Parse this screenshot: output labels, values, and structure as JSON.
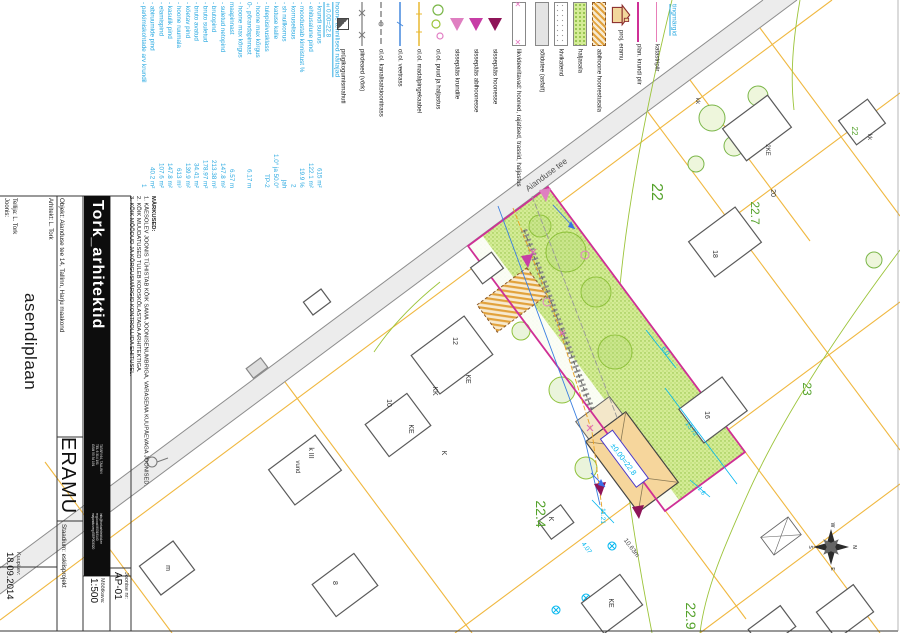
{
  "titleblock": {
    "joonis_label": "Joonis:",
    "tellija": "Tellija: L. Tork",
    "arhitekt": "Arhitekt: L. Tork",
    "drawing_title": "asendiplaan",
    "objekt": "Objekt: Aianduse tee 14, Tallinn, Harju maakond",
    "project_name": "ERAMU",
    "staadium": "Staadium: eskiisprojekt",
    "kuupaev_label": "Kuupäev:",
    "kuupaev": "18.09.2014",
    "mootkava_label": "Mõõtkava:",
    "mootkava": "1:500",
    "joonise_nr_label": "Joonise nr:",
    "joonise_nr": "AP-01",
    "logo": "Tork_arhitektid",
    "address": [
      "TATARI 64, TALLINN",
      "TEL 6 314 191",
      "GSM 50 34 191"
    ],
    "registry": [
      "info@torkarhitektid.ee",
      "reg.kood 80319140",
      "majandusreg EEP003320"
    ]
  },
  "notes": {
    "header": "MÄRKUSED:",
    "items": [
      "1. KÄESOLEV JOONIS TÜHISTAB KÕIK SAMA JOONISENUMBRIGA, VARASEMA KUUPÄEVAGA JOONISED.",
      "2. KÕIK MUUDATUSED TULEB KOOSKÕLASTADA ARHITEKTIGA.",
      "3. KÕIK MÕÕDUD JA KÕRGUSMÄRGID KONTROLLIDA EHITUSEL."
    ]
  },
  "tech": {
    "header": "hoone tehnilised näitajad",
    "benchmark": "±0.00=22.8",
    "rows": [
      {
        "label": "krundi suurus",
        "value": "615 m²"
      },
      {
        "label": "ehitusalune pind",
        "value": "122.1 m²"
      },
      {
        "label": "moodustab kinnistust %",
        "value": "19.9 %"
      },
      {
        "label": "korruselisus",
        "value": "2"
      },
      {
        "label": "sh nullkorrus",
        "value": "jah"
      },
      {
        "label": "katuse kalle",
        "value": "1.0° ja 50.0°"
      },
      {
        "label": "tulepüsivusklass",
        "value": "TP-2"
      },
      {
        "label": "hoone max kõrgus",
        "value": ""
      },
      {
        "label": "0-, põrandapinnast",
        "value": "6.17 m"
      },
      {
        "label": "hoone max kõrgus",
        "value": ""
      },
      {
        "label": "maapinnast",
        "value": "6.57 m"
      },
      {
        "label": "suletud netopind",
        "value": "147.8 m²"
      },
      {
        "label": "brutopind",
        "value": "213.38 m²"
      },
      {
        "label": "bruto suletud",
        "value": "178.97 m²"
      },
      {
        "label": "bruto avatud",
        "value": "34.41 m²"
      },
      {
        "label": "köetav pind",
        "value": "139.9 m²"
      },
      {
        "label": "hoone ruumala",
        "value": "613 m³"
      },
      {
        "label": "kasulik pind",
        "value": "147.8 m²"
      },
      {
        "label": "elamispind",
        "value": "107.6 m²"
      },
      {
        "label": "abiruumide pind",
        "value": "40.2 m²"
      },
      {
        "label": "parkimiskohtade arv krundil",
        "value": "1"
      }
    ]
  },
  "legend": {
    "items": [
      {
        "label": "abihoone hoonestusala"
      },
      {
        "label": "haljasala"
      },
      {
        "label": "kivikatend"
      },
      {
        "label": "sõidutee (asfalt)"
      },
      {
        "label": "likvideeritavad: hooned, rajatised, trassid, haljastus"
      },
      {
        "label": "sissepääs hoonesse"
      },
      {
        "label": "sissepääs abihoonesse"
      },
      {
        "label": "sissepääs krundile"
      },
      {
        "label": "ol.ol. puud ja haljastus"
      },
      {
        "label": "ol.ol. madalpingekaabel"
      },
      {
        "label": "ol.ol. veetrass"
      },
      {
        "label": "ol.ol. kanalisatsioonitrass"
      },
      {
        "label": "piirdeaed (võrk)"
      },
      {
        "label": "prügikogumismahuti"
      }
    ]
  },
  "corner_legend": {
    "header": "tingmärgid",
    "items": [
      {
        "label": "katastripiir"
      },
      {
        "label": "plan. krundi piir"
      },
      {
        "label": "proj. eramu"
      }
    ]
  },
  "map": {
    "road_name": "Aianduse tee",
    "benchmark": "±0.00=22.8",
    "plots": {
      "p22": "22",
      "p227": "22.7",
      "p23": "23",
      "p224": "22.4",
      "p229": "22.9",
      "p22s": "22"
    },
    "dims": {
      "d1": "13.72",
      "d2": "1.6",
      "d3": "11.21",
      "d4": "4.07",
      "d5": "6.0",
      "side": "10.63m"
    },
    "houses": {
      "h20": "20",
      "h18": "18",
      "h16": "16",
      "h12": "12",
      "h10": "10",
      "h8": "8",
      "hm": "m",
      "ke1": "KE",
      "kk1": "KK",
      "ke2": "KE",
      "k1": "K",
      "kIII": "k III",
      "vund": "vund",
      "keb": "KE",
      "ks": "K",
      "kk2": "kk",
      "kk3": "kk",
      "h2ke": "2KE"
    },
    "compass": {
      "n": "N",
      "e": "E",
      "s": "S",
      "w": "W"
    }
  },
  "colors": {
    "cyan_text": "#2aa9e1",
    "dim_cyan": "#00b6ef",
    "plot_green": "#54a22b",
    "boundary_yellow": "#f0b840",
    "fence_magenta": "#cf2f96",
    "katastri_pink": "#e87fb8",
    "grass": "#d4ec96",
    "road_gray": "#ececec",
    "building_tan": "#f6d69c"
  }
}
